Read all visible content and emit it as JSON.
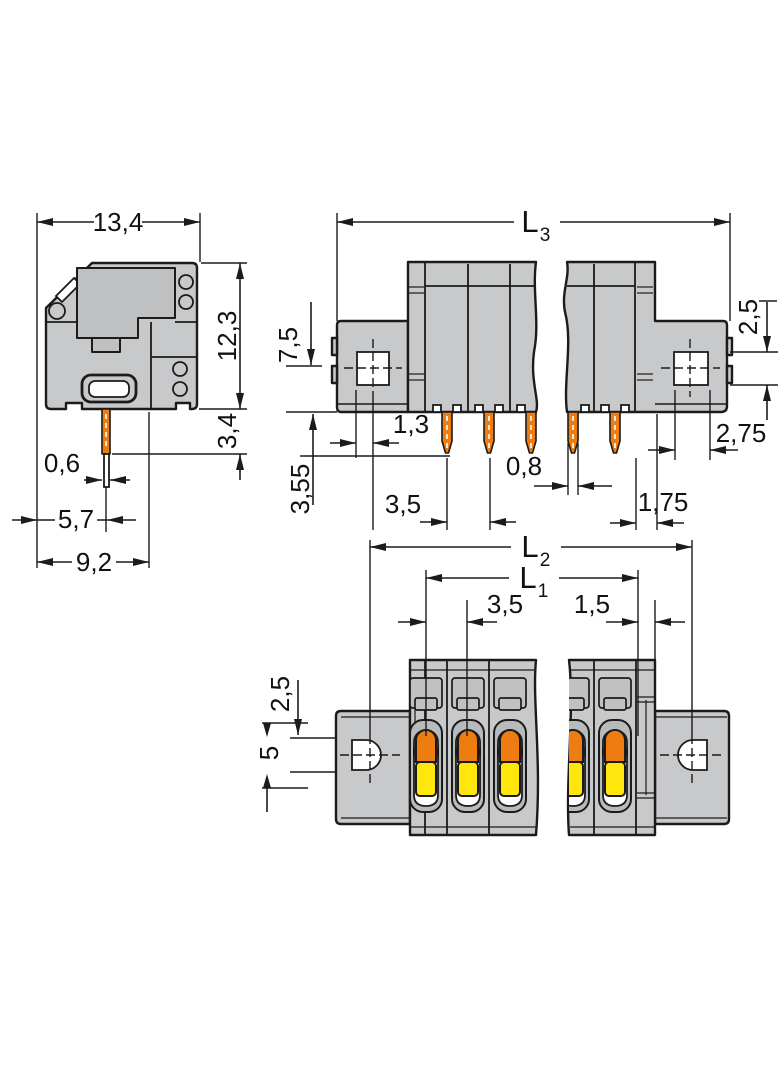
{
  "meta": {
    "description": "Technical dimension drawing of a PCB terminal block (three views, millimetre dimensions)"
  },
  "colors": {
    "body_gray": "#c8c9cb",
    "inner_gray": "#bfc0c2",
    "pin_orange": "#ee7d11",
    "lever_orange": "#ee7d11",
    "button_yellow": "#ffe70e",
    "line": "#1b1b1b",
    "background": "#ffffff"
  },
  "side_view": {
    "dim_width": "13,4",
    "dim_height": "12,3",
    "dim_pin_length": "3,4",
    "dim_pin_width": "0,6",
    "dim_pin_offset": "5,7",
    "dim_base_width": "9,2"
  },
  "front_view": {
    "dim_length_main": "L",
    "dim_length_sub": "3",
    "dim_hole_drop": "7,5",
    "dim_pin_protrusion": "3,55",
    "dim_hole_offset": "1,3",
    "dim_pitch": "3,5",
    "dim_pin_width": "0,8",
    "dim_hole_height": "2,5",
    "dim_hole_width": "2,75",
    "dim_end_offset": "1,75"
  },
  "top_view": {
    "dim_outer_main": "L",
    "dim_outer_sub": "2",
    "dim_inner_main": "L",
    "dim_inner_sub": "1",
    "dim_pitch": "3,5",
    "dim_end_offset": "1,5",
    "dim_edge": "2,5",
    "dim_hole_span": "5"
  }
}
